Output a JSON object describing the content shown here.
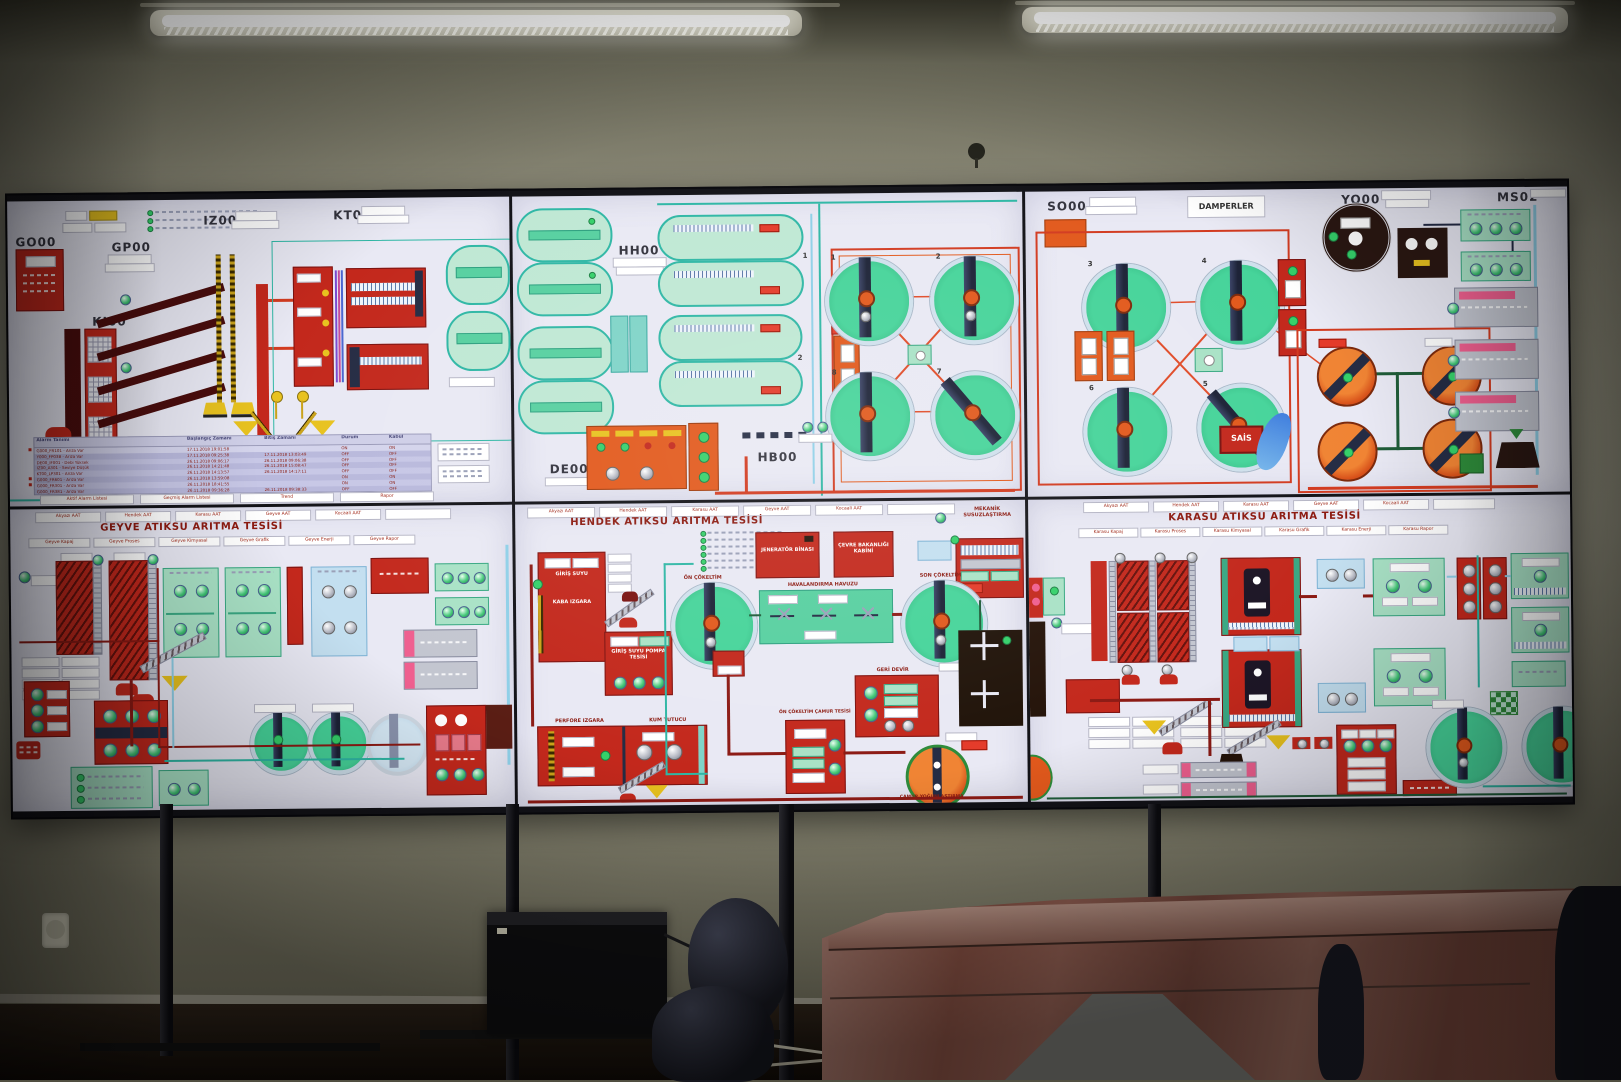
{
  "colors": {
    "screen_bg": "#e9e9f4",
    "scada_red": "#c3281c",
    "scada_orange": "#e2591c",
    "scada_green": "#3ecb92",
    "scada_mint": "#a9e2c6",
    "scada_teal": "#2fb7a5",
    "scada_navy": "#252c44",
    "scada_yellow": "#e8c21f",
    "alarm_row": "#bdbdde",
    "title_red": "#8c1a10",
    "wall": "#8f8d7b",
    "ceiling": "#4f4e3f",
    "floor": "#1c120c",
    "table": "#7c4a3e",
    "chair": "#16171e"
  },
  "video_wall": {
    "nav_plants": [
      "Akyazı AAT",
      "Hendek AAT",
      "Karasu AAT",
      "Geyve AAT",
      "Kocaali AAT"
    ],
    "top_left": {
      "codes": {
        "go00": "GO00",
        "ki00": "KI00",
        "gp00": "GP00",
        "iz00": "IZ00",
        "kt00": "KT00"
      },
      "alarm_table": {
        "headers": [
          "Alarm Tanımı",
          "Başlangıç Zamanı",
          "Bitiş Zamanı",
          "Durum",
          "Kabul"
        ],
        "rows": [
          [
            "G000_FR101 - Arıza Var",
            "17.11.2018 19:01:58",
            "",
            "ON",
            "ON"
          ],
          [
            "Y000_FP03B - Arıza Var",
            "17.11.2018 09:25:38",
            "17.11.2018 13:03:49",
            "OFF",
            "OFF"
          ],
          [
            "DE00_IF001 - Debi Yüksek",
            "26.11.2018 09:06:17",
            "26.11.2018 09:06:38",
            "OFF",
            "OFF"
          ],
          [
            "IZ00_A301 - Seviye Düşük",
            "26.11.2018 14:21:48",
            "26.11.2018 15:08:47",
            "OFF",
            "OFF"
          ],
          [
            "KT00_LP301 - Arıza Var",
            "26.11.2018 14:13:57",
            "26.11.2018 14:17:11",
            "OFF",
            "OFF"
          ],
          [
            "G000_FR601 - Arıza Var",
            "26.11.2018 13:59:08",
            "",
            "ON",
            "ON"
          ],
          [
            "G000_FR301 - Arıza Var",
            "26.11.2018 18:41:55",
            "",
            "ON",
            "ON"
          ],
          [
            "G000_FR381 - Arıza Var",
            "26.11.2018 09:36:28",
            "26.11.2018 09:38:33",
            "OFF",
            "OFF"
          ]
        ],
        "footer": [
          "Aktif Alarm Listesi",
          "Geçmiş Alarm Listesi",
          "Trend",
          "Rapor"
        ]
      }
    },
    "top_middle": {
      "codes": {
        "hh00": "HH00",
        "hb00": "HB00",
        "de00": "DE00"
      },
      "basin_numbers": [
        "1",
        "2"
      ],
      "clarifier_numbers": [
        "1",
        "2",
        "8",
        "7"
      ]
    },
    "top_right": {
      "codes": {
        "so00": "SO00",
        "yo00": "YO00",
        "ms02": "MS02"
      },
      "damperler_label": "DAMPERLER",
      "sais_label": "SAİS",
      "clarifier_numbers": [
        "3",
        "4",
        "6",
        "5"
      ]
    },
    "bottom_left": {
      "title": "GEYVE ATIKSU ARITMA TESİSİ",
      "nav_sub": [
        "Geyve Kapaj",
        "Geyve Proses",
        "Geyve Kimyasal",
        "Geyve Grafik",
        "Geyve Enerji",
        "Geyve Rapor"
      ]
    },
    "bottom_middle": {
      "title": "HENDEK ATIKSU ARITMA TESİSİ",
      "labels": {
        "giris_suyu": "GİRİŞ SUYU",
        "kaba_izgara": "KABA IZGARA",
        "pompa": "GİRİŞ SUYU POMPA TESİSİ",
        "on_cokeltim": "ÖN ÇÖKELTİM",
        "havalandirma": "HAVALANDIRMA HAVUZU",
        "son_cokeltim": "SON ÇÖKELTİM",
        "jenerator": "JENERATÖR BİNASI",
        "cevre": "ÇEVRE BAKANLIĞI KABİNİ",
        "mekanik": "MEKANİK SUSUZLAŞTIRMA",
        "geri_devir": "GERİ DEVİR",
        "perfore": "PERFORE IZGARA",
        "kum": "KUM TUTUCU",
        "camur_tesisi": "ÖN ÇÖKELTİM ÇAMUR TESİSİ",
        "yogunlastirma": "ÇAMUR YOĞUNLAŞTIRMA"
      }
    },
    "bottom_right": {
      "title": "KARASU ATIKSU ARITMA TESİSİ",
      "nav_sub": [
        "Karasu Kapaj",
        "Karasu Proses",
        "Karasu Kimyasal",
        "Karasu Grafik",
        "Karasu Enerji",
        "Karasu Rapor"
      ]
    }
  }
}
